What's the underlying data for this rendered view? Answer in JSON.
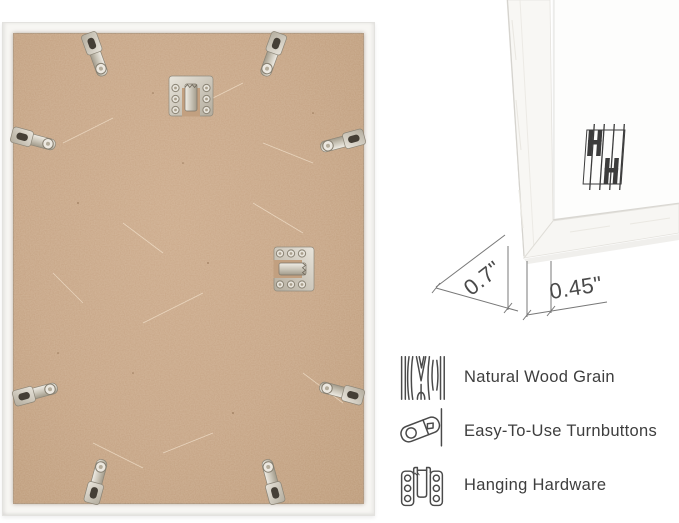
{
  "measurements": {
    "frame_depth": "0.7\"",
    "frame_face_width": "0.45\""
  },
  "features": [
    {
      "icon": "wood-grain-icon",
      "label": "Natural Wood Grain"
    },
    {
      "icon": "turnbutton-icon",
      "label": "Easy-To-Use Turnbuttons"
    },
    {
      "icon": "hanging-hardware-icon",
      "label": "Hanging Hardware"
    }
  ],
  "hardware_shown": {
    "turnbutton_count": 8,
    "sawtooth_hanger_count": 2
  },
  "icons": {
    "brand_logo": "hh-monogram-logo-icon"
  },
  "colors": {
    "background": "#ffffff",
    "backing_board": "#c5a384",
    "frame_white": "#f7f6f3",
    "metal": "#d5d0c5",
    "text": "#3e3e3e",
    "dimension_lines": "#6f6f6f",
    "logo": "#3c3c3c"
  }
}
